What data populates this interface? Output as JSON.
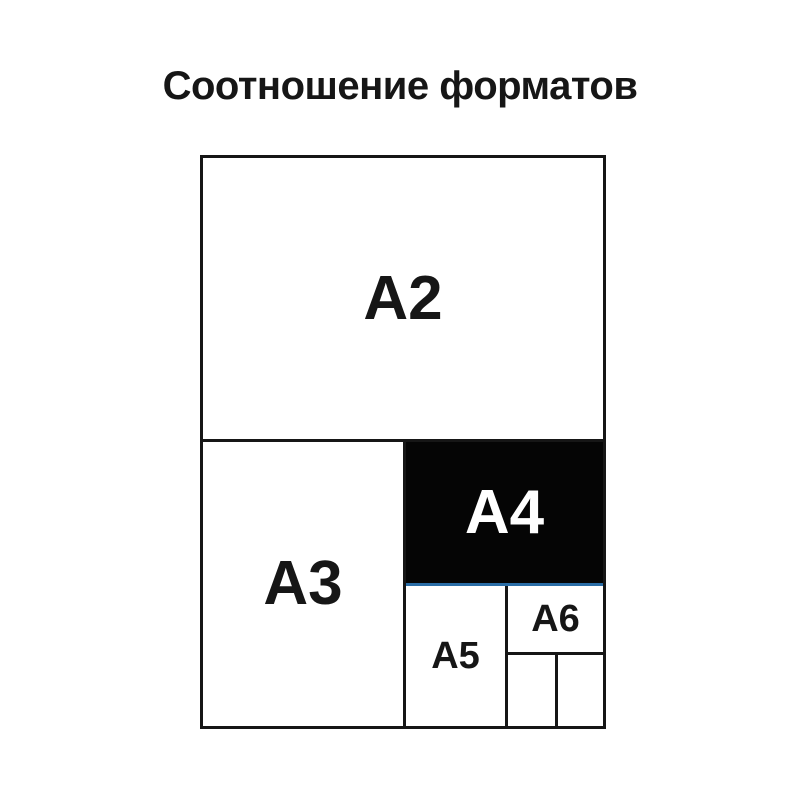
{
  "title": "Соотношение форматов",
  "diagram": {
    "formats": [
      {
        "label": "A2",
        "highlighted": false
      },
      {
        "label": "A3",
        "highlighted": false
      },
      {
        "label": "A4",
        "highlighted": true
      },
      {
        "label": "A5",
        "highlighted": false
      },
      {
        "label": "A6",
        "highlighted": false
      }
    ],
    "colors": {
      "background": "#ffffff",
      "outline": "#161616",
      "label_text": "#161616",
      "highlight_bg": "#050505",
      "highlight_text": "#ffffff",
      "accent_line": "#2a6da6"
    }
  }
}
